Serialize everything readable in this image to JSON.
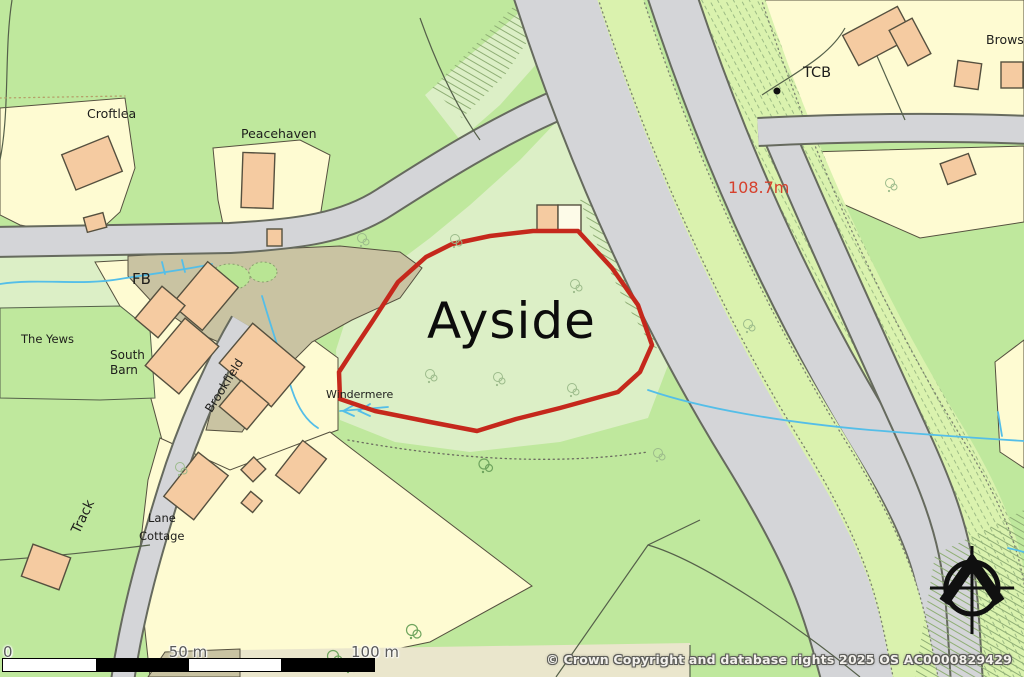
{
  "map": {
    "title": "Ayside location plan",
    "labels": {
      "croftlea": "Croftlea",
      "peacehaven": "Peacehaven",
      "fb": "FB",
      "the_yews": "The Yews",
      "south_barn_line1": "South",
      "south_barn_line2": "Barn",
      "brookfield": "Brookfield",
      "windermere": "Windermere",
      "ayside": "Ayside",
      "track": "Track",
      "lane_cottage_line1": "Lane",
      "lane_cottage_line2": "Cottage",
      "tcb": "TCB",
      "browside": "Browside",
      "spot_height": "108.7m"
    },
    "scale_bar": {
      "zero": "0",
      "mid": "50 m",
      "end": "100 m"
    },
    "copyright": "© Crown Copyright and database rights 2025 OS AC0000829429",
    "colors": {
      "field": "#bfe89d",
      "light": "#dcefc6",
      "median": "#daf2ae",
      "road": "#d4d5d8",
      "case": "#666a5e",
      "plot": "#fefbd2",
      "plot2": "#eae6cc",
      "tan": "#c9c3a2",
      "bldg": "#f5cba1",
      "ink": "#55503f",
      "stream": "#54bee8",
      "bdry": "#c5281c",
      "spot": "#d6402c"
    }
  }
}
